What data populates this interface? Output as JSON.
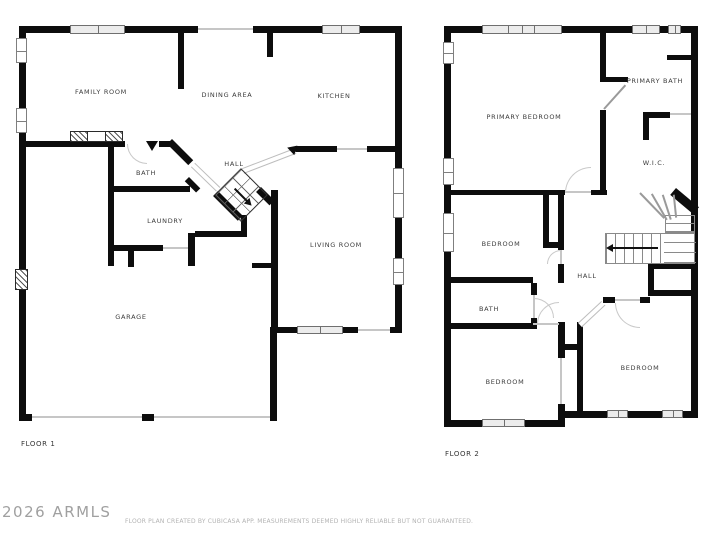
{
  "floor1": {
    "label": "FLOOR 1",
    "rooms": [
      {
        "label": "FAMILY ROOM"
      },
      {
        "label": "DINING AREA"
      },
      {
        "label": "KITCHEN"
      },
      {
        "label": "BATH"
      },
      {
        "label": "HALL"
      },
      {
        "label": "LAUNDRY"
      },
      {
        "label": "LIVING ROOM"
      },
      {
        "label": "GARAGE"
      }
    ]
  },
  "floor2": {
    "label": "FLOOR 2",
    "rooms": [
      {
        "label": "PRIMARY BEDROOM"
      },
      {
        "label": "PRIMARY BATH"
      },
      {
        "label": "W.I.C."
      },
      {
        "label": "BEDROOM"
      },
      {
        "label": "HALL"
      },
      {
        "label": "BATH"
      },
      {
        "label": "BEDROOM"
      },
      {
        "label": "BEDROOM"
      }
    ]
  },
  "footer": {
    "watermark": "2026 ARMLS",
    "disclaimer": "FLOOR PLAN CREATED BY CUBICASA APP. MEASUREMENTS DEEMED HIGHLY RELIABLE BUT NOT GUARANTEED."
  },
  "colors": {
    "wall": "#0d0d0d",
    "opening_line": "#c6c6c6",
    "room_label": "#3c3c3c",
    "watermark": "#a0a0a0",
    "disclaimer": "#b3b3b3"
  }
}
